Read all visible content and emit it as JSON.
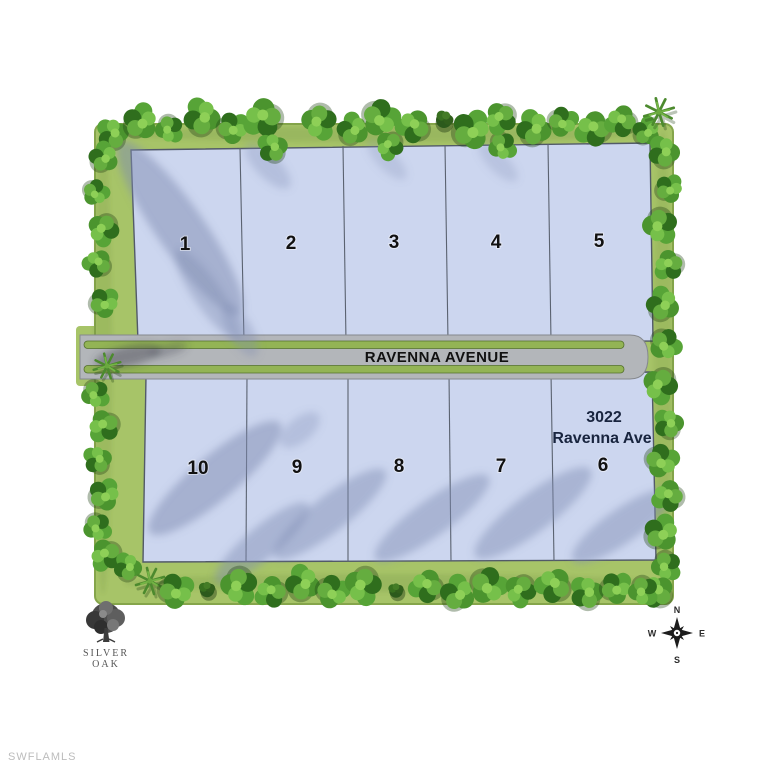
{
  "watermark": "SWFLAMLS",
  "street": {
    "name": "RAVENNA AVENUE"
  },
  "address": {
    "line1": "3022",
    "line2": "Ravenna Ave"
  },
  "lots": {
    "north_row": [
      "1",
      "2",
      "3",
      "4",
      "5"
    ],
    "south_row": [
      "10",
      "9",
      "8",
      "7",
      "6"
    ]
  },
  "compass": {
    "n": "N",
    "e": "E",
    "s": "S",
    "w": "W"
  },
  "logo": {
    "line1": "SILVER",
    "line2": "OAK"
  },
  "colors": {
    "grass": "#a7c468",
    "lot_fill": "#ccd6ef",
    "road": "#b3b6ba",
    "median_green": "#93b455",
    "tree_green": "#4b942e",
    "address_text": "#18243e",
    "watermark_text": "#bcbcbc"
  }
}
